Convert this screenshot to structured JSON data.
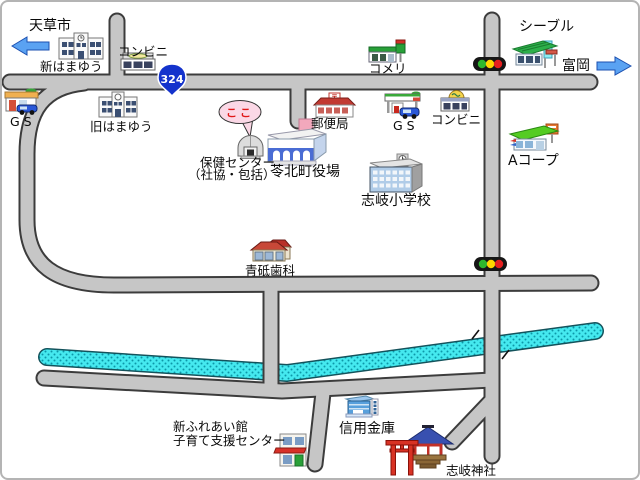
{
  "labels": {
    "amakusa": "天草市",
    "shin_hamayu": "新はまゆう",
    "conbini_nw": "コンビニ",
    "kyu_hamayu": "旧はまゆう",
    "gs_west": "GS",
    "hoken_line1": "保健センター",
    "hoken_line2": "（社協・包括）",
    "yakuba": "苓北町役場",
    "post_office": "郵便局",
    "komeri": "コメリ",
    "gs_east": "GS",
    "conbini_ne": "コンビニ",
    "cieble": "シーブル",
    "tomioka": "富岡",
    "a_coop": "Aコープ",
    "elementary": "志岐小学校",
    "dental": "青砥歯科",
    "bank": "信用金庫",
    "fureai_line1": "新ふれあい館",
    "fureai_line2": "子育て支援センター",
    "shrine": "志岐神社",
    "here": "ここ",
    "route": "324",
    "post_mark": "〒"
  },
  "colors": {
    "road": "#c6c6c6",
    "road_outline": "#3c3c3c",
    "river": "#45e9ef",
    "river_dots": "#0c98a8",
    "arrow": "#5aa2f2",
    "route_badge": "#1433cc",
    "bubble": "#fbd8e6",
    "bubble_text": "#e01818",
    "signal_green": "#2eb82e",
    "signal_yellow": "#ffd700",
    "signal_red": "#e62020"
  },
  "icons": {
    "west_arrow": "blue arrow pointing left toward Amakusa city",
    "east_arrow": "blue arrow pointing right toward Tomioka",
    "traffic_lights": "two horizontal green-yellow-red signals",
    "route_badge": "blue national route 324 shield",
    "river": "cyan dotted river band with two bridges",
    "here_bubble": "pink speech bubble pointing at health center dome"
  }
}
